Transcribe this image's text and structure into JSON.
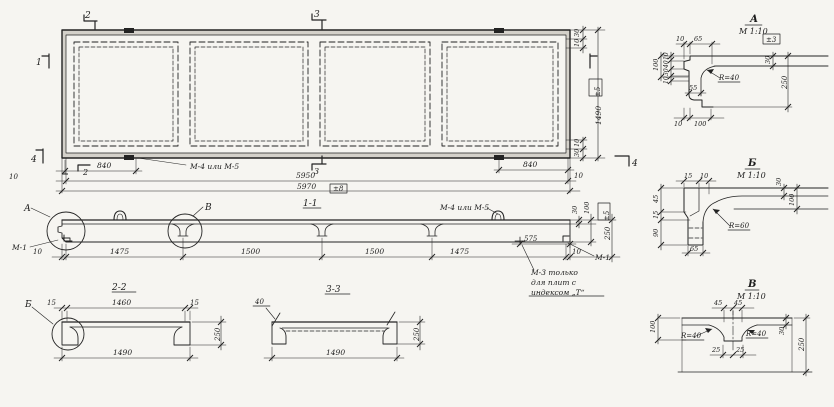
{
  "colors": {
    "ink": "#232323",
    "paper": "#f6f5f1"
  },
  "plan": {
    "cut_marker_2_top": "2",
    "cut_marker_3_top": "3",
    "cut_marker_1_left": "1",
    "cut_marker_4_left": "4",
    "cut_marker_2_bottom": "2",
    "cut_marker_3_bottom": "3",
    "cut_marker_4_right": "4",
    "anchor_label": "М-4 или М-5",
    "dim_840_left": "840",
    "dim_840_right": "840",
    "dim_10_left": "10",
    "dim_10_right": "10",
    "dim_5950": "5950",
    "dim_5970": "5970",
    "tol_5970": "±8",
    "dim_30_top": "30",
    "dim_10_top": "10",
    "tol_1490": "±5",
    "dim_1490": "1490",
    "dim_10_bottom": "10",
    "dim_30_bottom": "30"
  },
  "section11": {
    "title": "1-1",
    "detail_a_ref": "А",
    "detail_v_ref": "В",
    "m1_left": "М-1",
    "m1_right": "М-1",
    "anchor_label": "М-4 или М-5",
    "m3_note": [
      "М-3 только",
      "для плит с",
      "индексом „Т“"
    ],
    "dim_10_left": "10",
    "seg1": "1475",
    "seg2": "1500",
    "seg3": "1500",
    "seg4": "1475",
    "dim_575": "575",
    "dim_10_right": "10",
    "dim_30": "30",
    "dim_100": "100",
    "tol": "±5",
    "dim_250": "250"
  },
  "section22": {
    "title": "2-2",
    "detail_b_ref": "Б",
    "dim_15_left": "15",
    "dim_1460": "1460",
    "dim_15_right": "15",
    "dim_1490": "1490",
    "dim_250": "250"
  },
  "section33": {
    "title": "3-3",
    "dim_40": "40",
    "dim_1490": "1490",
    "dim_250": "250"
  },
  "detailA": {
    "title": "А",
    "scale": "М 1:10",
    "dim_10_top": "10",
    "dim_65": "65",
    "tol": "±3",
    "dim_30_flange": "30",
    "radius": "R=40",
    "dim_100_left": "100",
    "dim_10_a": "10",
    "dim_40": "40",
    "dim_30_left": "30",
    "dim_10_b": "10",
    "dim_55": "55",
    "dim_250": "250",
    "dim_10_bottom": "10",
    "dim_100_bottom": "100"
  },
  "detailB": {
    "title": "Б",
    "scale": "М 1:10",
    "dim_15_top": "15",
    "dim_10_top": "10",
    "dim_45": "45",
    "dim_15_left": "15",
    "dim_90": "90",
    "dim_30": "30",
    "dim_100": "100",
    "radius": "R=60",
    "dim_65": "65"
  },
  "detailV": {
    "title": "В",
    "scale": "М 1:10",
    "dim_45_left": "45",
    "dim_45_right": "45",
    "dim_100": "100",
    "dim_30": "30",
    "dim_250": "250",
    "dim_25_left": "25",
    "dim_25_right": "25",
    "radius_left": "R=40",
    "radius_right": "R=40"
  }
}
